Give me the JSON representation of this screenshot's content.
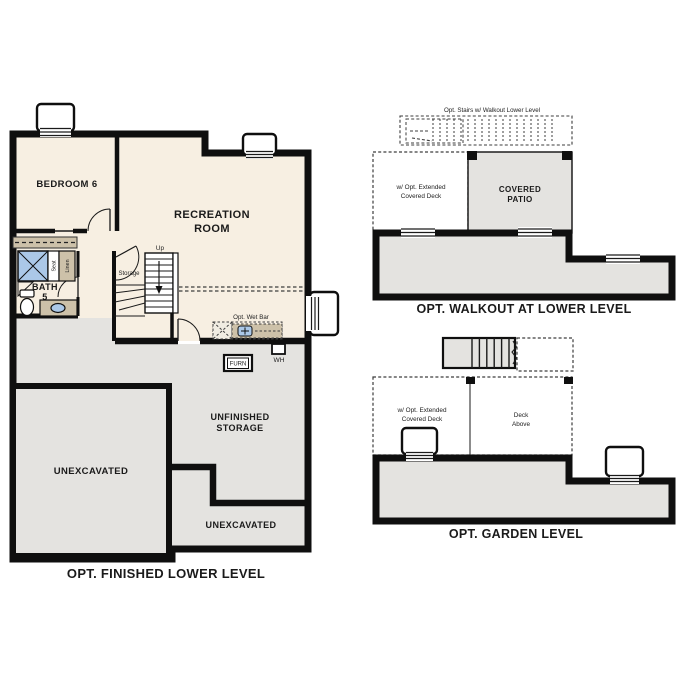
{
  "colors": {
    "finished_floor": "#f7efe2",
    "unfinished_floor": "#e4e3e0",
    "counter_tan": "#cdc1a9",
    "fixture_blue": "#abc8e8",
    "wall": "#0f0f0f"
  },
  "finished_lower_level": {
    "caption": "OPT. FINISHED LOWER LEVEL",
    "rooms": {
      "bedroom": "BEDROOM 6",
      "recreation_line1": "RECREATION",
      "recreation_line2": "ROOM",
      "bath_line1": "BATH",
      "bath_line2": "5",
      "unfinished_storage_line1": "UNFINISHED",
      "unfinished_storage_line2": "STORAGE",
      "unexcavated_large": "UNEXCAVATED",
      "unexcavated_small": "UNEXCAVATED"
    },
    "annotations": {
      "storage": "Storage",
      "up": "Up",
      "seat": "Seat",
      "linen": "Linen",
      "wet_bar": "Opt. Wet Bar",
      "water_heater": "WH",
      "furnace": "FURN"
    }
  },
  "walkout_level": {
    "caption": "OPT. WALKOUT AT LOWER LEVEL",
    "stairs_note": "Opt. Stairs w/ Walkout Lower Level",
    "deck_note_line1": "w/ Opt. Extended",
    "deck_note_line2": "Covered Deck",
    "patio_line1": "COVERED",
    "patio_line2": "PATIO"
  },
  "garden_level": {
    "caption": "OPT. GARDEN LEVEL",
    "deck_note_line1": "w/ Opt. Extended",
    "deck_note_line2": "Covered Deck",
    "deck_above_line1": "Deck",
    "deck_above_line2": "Above"
  }
}
